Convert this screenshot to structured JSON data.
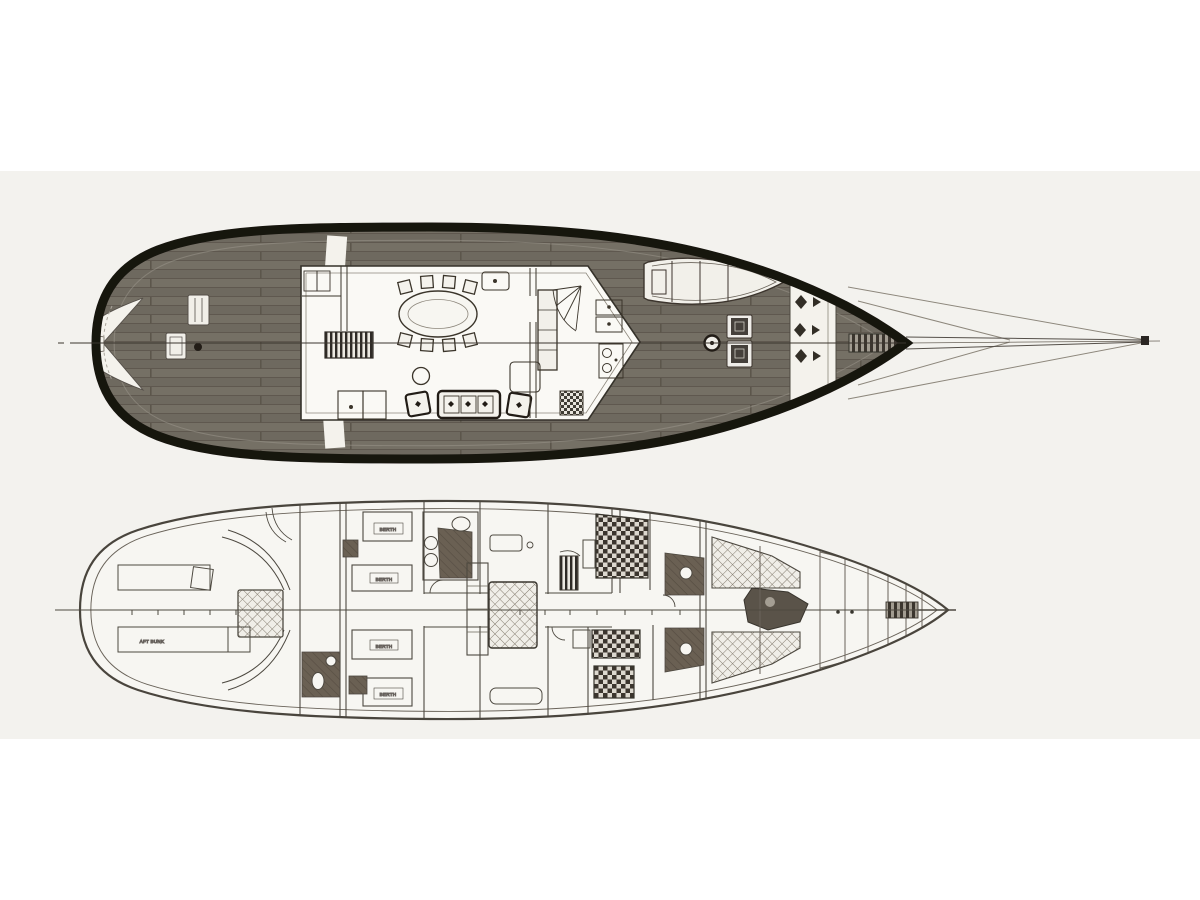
{
  "document": {
    "kind": "yacht deck plan drawing",
    "views": {
      "upper": "upper-deck-plan",
      "lower": "lower-deck-plan"
    }
  },
  "colors": {
    "paper": "#ffffff",
    "scan_band": "#f3f2ee",
    "hull_outline": "#16120e",
    "deck_plank": "#6f6a60",
    "deck_plank_alt": "#736e64",
    "drawing_line": "#4d4841",
    "light_line": "#8d877c",
    "dark_fill": "#39342d",
    "head_floor": "#6b6053",
    "white_fill": "#f4f2ec"
  },
  "lower_deck": {
    "labels": {
      "aft_bunk": "AFT BUNK",
      "berth_1": "BERTH",
      "berth_2": "BERTH",
      "berth_3": "BERTH",
      "berth_4": "BERTH"
    }
  }
}
